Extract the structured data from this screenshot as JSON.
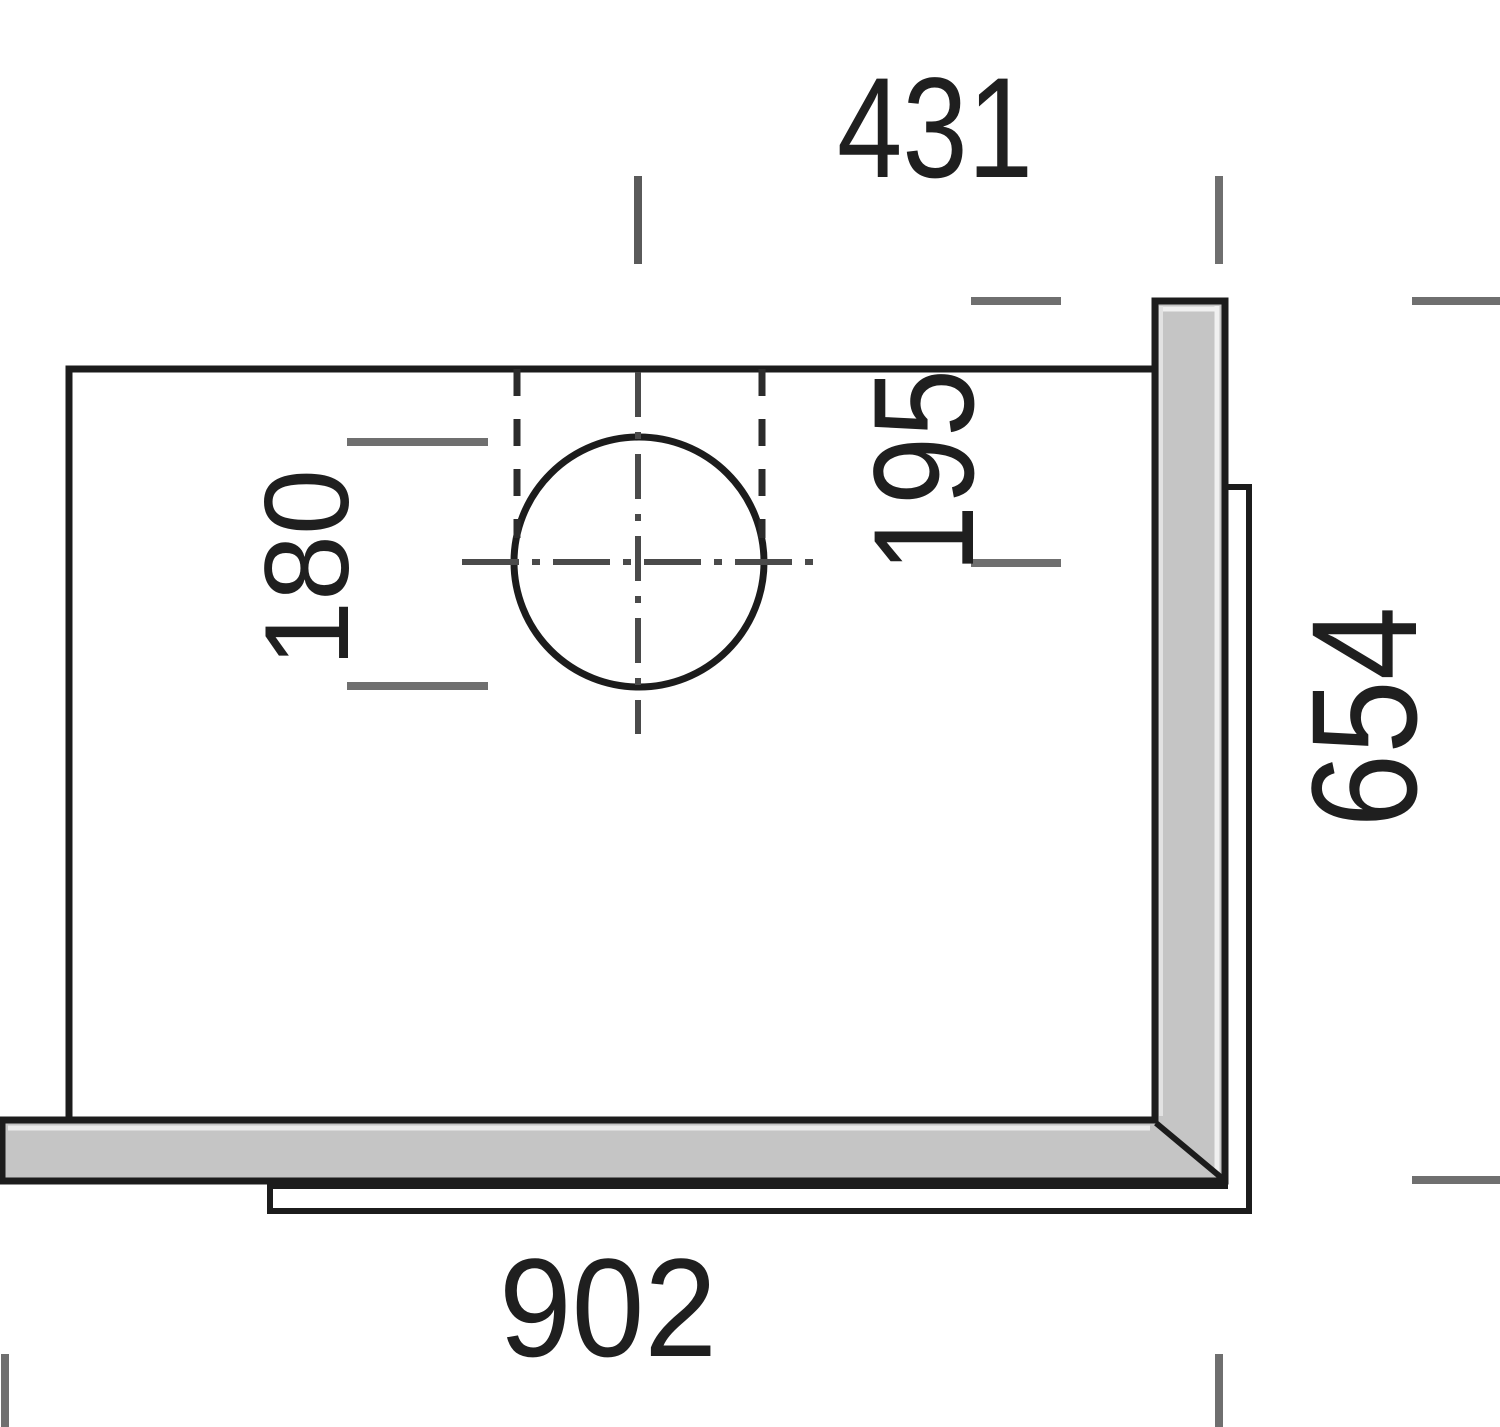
{
  "drawing": {
    "description": "Technical plan drawing of a worktop panel with circular cut-out and dimension ticks",
    "dimensions": {
      "top_width": "431",
      "cutout_offset": "195",
      "cutout_diameter": "180",
      "side_depth": "654",
      "bottom_width": "902"
    },
    "colors": {
      "outline": "#1c1c1c",
      "dimension_tick": "#6f6f6f",
      "centerline": "#4a4a4a",
      "panel_fill": "#c5c5c5",
      "label_text": "#1f1f1f",
      "background": "#ffffff"
    }
  }
}
